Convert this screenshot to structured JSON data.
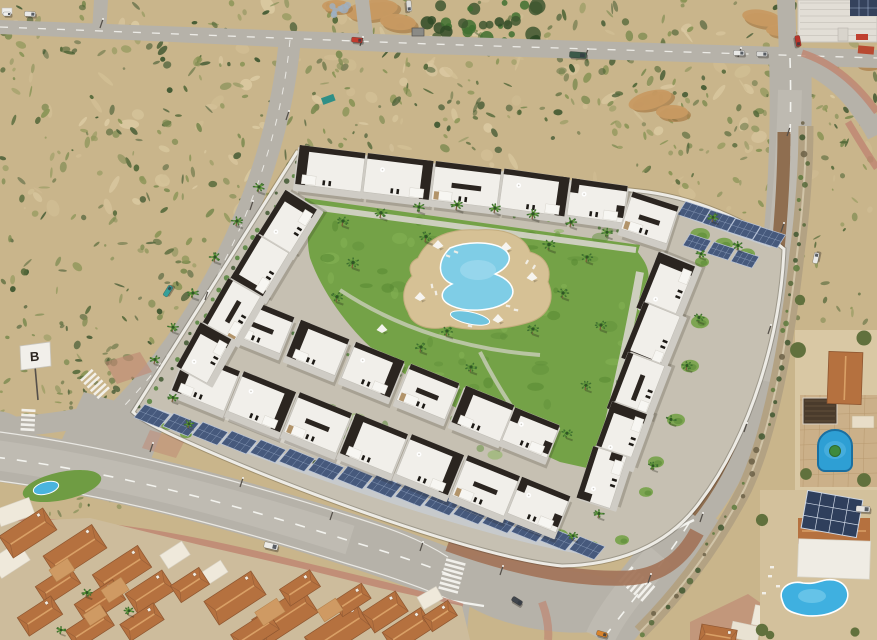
{
  "scene": {
    "kind": "aerial-photograph",
    "subject": "Aerial view of a new-build residential complex with communal lawn, curved swimming pool, palm trees and solar carports, bordered by roads, sandy scrubland, a Spanish tiled-roof neighbourhood and villas with private pools",
    "billboard": {
      "label": "B"
    },
    "palette": {
      "sand": "#c9b58b",
      "sand_light": "#dbcaa2",
      "scrub_olive": "#7c8a50",
      "scrub_dark": "#55693a",
      "scrub_deep": "#3f5730",
      "mound": "#c89a62",
      "mound_dark": "#a87b46",
      "road": "#b6b2a9",
      "road_light": "#c7c3bb",
      "road_line": "#f6f5f1",
      "sidewalk_red": "#bf8773",
      "dirt_strip": "#8f6e50",
      "stone_strip": "#b3a283",
      "lawn": "#74a247",
      "lawn_dark": "#5f8f3a",
      "lawn_light": "#86b455",
      "pool_water": "#7fcde6",
      "pool_light": "#aadff0",
      "pool_deck": "#d6c195",
      "building_white": "#f1efea",
      "building_shade": "#cfccc5",
      "building_dark": "#2b2520",
      "stone_clad": "#b2946a",
      "solar_panel": "#46597c",
      "solar_lines": "#9fb0cc",
      "carport_gray": "#c7cacd",
      "wall_white": "#edebe5",
      "terracotta": "#b5713f",
      "terracotta_light": "#d9a066",
      "terracotta_shadow": "#8e5630",
      "orange_wall": "#d28a4e",
      "patio_tile": "#cf9a63",
      "villa_pool": "#2e9fd4",
      "villa_pool_light": "#55b8e2",
      "kidney_pool": "#3fb0e0",
      "palm_green": "#3f7030",
      "palm_light": "#6fae3f",
      "trunk": "#7a5c3a",
      "shadow": "rgba(35,30,22,0.35)"
    }
  }
}
